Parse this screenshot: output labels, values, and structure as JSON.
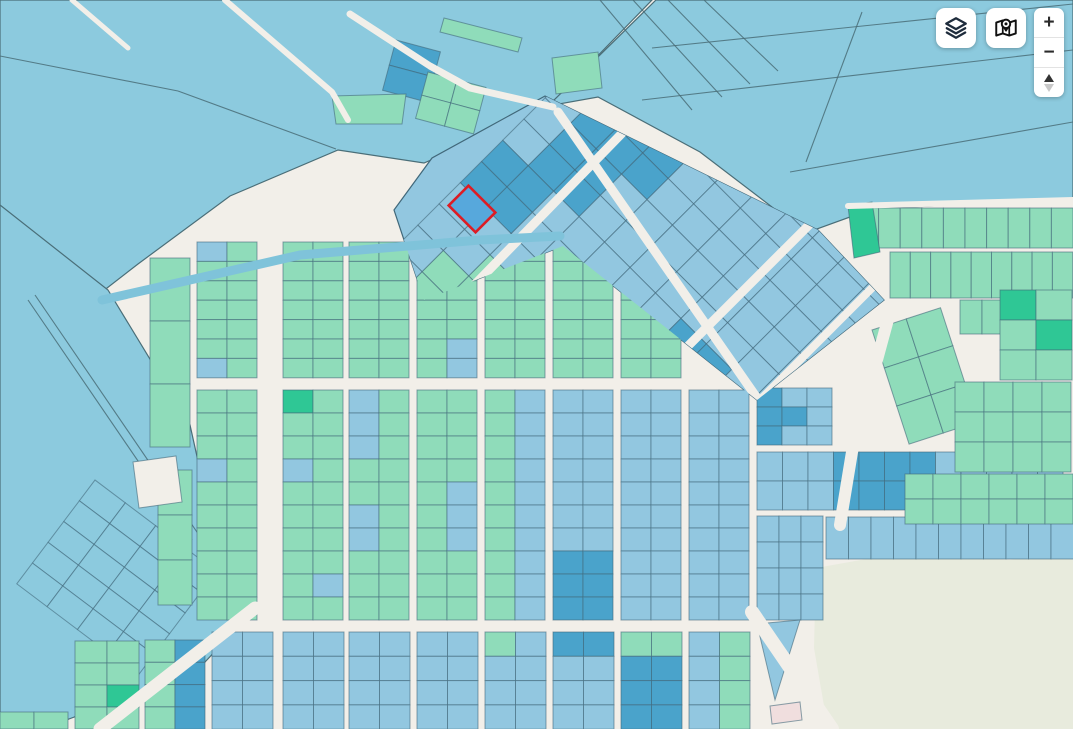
{
  "controls": {
    "zoom_in_label": "+",
    "zoom_out_label": "−",
    "layers_button": {
      "icon": "layers-icon"
    },
    "basemap_button": {
      "icon": "map-pin-icon"
    }
  },
  "palette": {
    "street": "#f2efe9",
    "field": "#8ccade",
    "blue": "#92c7e0",
    "darkBlue": "#4aa3cb",
    "green": "#8fdcba",
    "darkGreen": "#2fc795",
    "beige": "#e8ebdd",
    "border": "#41687a",
    "fieldLine": "#4a6e78",
    "water": "#7fc3da",
    "pink": "#f0dede",
    "red": "#dd1c24",
    "selBlue": "#57a8dc",
    "iconNavy": "#1e2c3c",
    "iconBlack": "#111111"
  },
  "map": {
    "w": 1073,
    "h": 729,
    "clips": {
      "zone": "545,96 818,230 884,300 757,400 563,246 424,300 394,210 432,158",
      "upper": "185,232 562,232 760,404 185,404"
    },
    "regions": [
      {
        "name": "field-top-left",
        "pts": "0,0 652,0 543,112 424,163 338,150 230,196 138,264 40,340 0,362",
        "f": "field",
        "s": "fieldLine"
      },
      {
        "name": "field-top-right",
        "pts": "656,0 1073,0 1073,199 872,209 806,233 700,152 598,97 548,106",
        "f": "field",
        "s": "fieldLine"
      },
      {
        "name": "field-left",
        "pts": "0,205 108,290 190,425 220,560 252,612 205,662 120,700 42,729 0,729",
        "f": "field",
        "s": "fieldLine"
      },
      {
        "name": "diamond-zone",
        "pts": "545,96 818,230 884,300 757,400 563,246 424,300 394,210 432,158",
        "f": "blue",
        "s": "border"
      },
      {
        "name": "park",
        "pts": "816,568 900,553 1010,560 1073,549 1073,729 828,729 814,648",
        "f": "beige",
        "s": "none"
      }
    ],
    "lines": [
      [
        70,
        0,
        128,
        47
      ],
      [
        0,
        56,
        178,
        91
      ],
      [
        178,
        91,
        336,
        149
      ],
      [
        652,
        48,
        1073,
        4
      ],
      [
        642,
        100,
        1073,
        50
      ],
      [
        790,
        172,
        1073,
        122
      ],
      [
        862,
        12,
        806,
        162
      ],
      [
        600,
        0,
        692,
        110
      ],
      [
        633,
        0,
        722,
        97
      ],
      [
        668,
        0,
        750,
        84
      ],
      [
        704,
        0,
        778,
        71
      ],
      [
        28,
        300,
        192,
        540
      ],
      [
        35,
        295,
        199,
        535
      ]
    ],
    "grids": [
      {
        "name": "mesh-bottom-left",
        "x": 95,
        "y": 480,
        "angle": 37,
        "cols": 4,
        "rows": 5,
        "cw": 38,
        "ch": 26,
        "f": "field"
      },
      {
        "name": "strip-left-a",
        "x": 150,
        "y": 258,
        "cols": 1,
        "rows": 3,
        "cw": 40,
        "ch": 63,
        "f": "green"
      },
      {
        "name": "strip-left-b",
        "x": 158,
        "y": 470,
        "cols": 1,
        "rows": 3,
        "cw": 34,
        "ch": 45,
        "f": "green"
      },
      {
        "name": "upper-1",
        "x": 197,
        "y": 242,
        "cols": 2,
        "rows": 7,
        "cw": 30,
        "ch": 19.4,
        "f": "green",
        "clip": "upper",
        "sp": [
          [
            0,
            0,
            "blue"
          ],
          [
            0,
            6,
            "blue"
          ]
        ]
      },
      {
        "name": "upper-2",
        "x": 283,
        "y": 242,
        "cols": 2,
        "rows": 7,
        "cw": 30,
        "ch": 19.4,
        "f": "green",
        "clip": "upper"
      },
      {
        "name": "upper-3",
        "x": 349,
        "y": 242,
        "cols": 2,
        "rows": 7,
        "cw": 30,
        "ch": 19.4,
        "f": "green",
        "clip": "upper"
      },
      {
        "name": "upper-4",
        "x": 417,
        "y": 242,
        "cols": 2,
        "rows": 7,
        "cw": 30,
        "ch": 19.4,
        "f": "green",
        "clip": "upper",
        "sp": [
          [
            1,
            5,
            "blue"
          ],
          [
            1,
            6,
            "blue"
          ]
        ]
      },
      {
        "name": "upper-5",
        "x": 485,
        "y": 242,
        "cols": 2,
        "rows": 7,
        "cw": 30,
        "ch": 19.4,
        "f": "green",
        "clip": "upper"
      },
      {
        "name": "upper-6",
        "x": 553,
        "y": 242,
        "cols": 2,
        "rows": 7,
        "cw": 30,
        "ch": 19.4,
        "f": "green",
        "clip": "upper"
      },
      {
        "name": "upper-7",
        "x": 621,
        "y": 242,
        "cols": 2,
        "rows": 7,
        "cw": 30,
        "ch": 19.4,
        "f": "green",
        "clip": "upper"
      },
      {
        "name": "mid-1",
        "x": 197,
        "y": 390,
        "cols": 2,
        "rows": 10,
        "cw": 30,
        "ch": 23,
        "f": "green",
        "sp": [
          [
            0,
            3,
            "blue"
          ]
        ]
      },
      {
        "name": "mid-2",
        "x": 283,
        "y": 390,
        "cols": 2,
        "rows": 10,
        "cw": 30,
        "ch": 23,
        "f": "green",
        "sp": [
          [
            0,
            0,
            "darkGreen"
          ],
          [
            0,
            3,
            "blue"
          ],
          [
            1,
            8,
            "blue"
          ]
        ]
      },
      {
        "name": "mid-3",
        "x": 349,
        "y": 390,
        "cols": 2,
        "rows": 10,
        "cw": 30,
        "ch": 23,
        "f": "green",
        "sp": [
          [
            0,
            0,
            "blue"
          ],
          [
            0,
            1,
            "blue"
          ],
          [
            0,
            2,
            "blue"
          ],
          [
            0,
            5,
            "blue"
          ],
          [
            0,
            6,
            "blue"
          ]
        ]
      },
      {
        "name": "mid-4",
        "x": 417,
        "y": 390,
        "cols": 2,
        "rows": 10,
        "cw": 30,
        "ch": 23,
        "f": "green",
        "sp": [
          [
            1,
            4,
            "blue"
          ],
          [
            1,
            5,
            "blue"
          ],
          [
            1,
            6,
            "blue"
          ]
        ]
      },
      {
        "name": "mid-5",
        "x": 485,
        "y": 390,
        "cols": 2,
        "rows": 10,
        "cw": 30,
        "ch": 23,
        "colFills": [
          "green",
          "blue"
        ]
      },
      {
        "name": "mid-6",
        "x": 553,
        "y": 390,
        "cols": 2,
        "rows": 10,
        "cw": 30,
        "ch": 23,
        "f": "blue",
        "sp": [
          [
            0,
            7,
            "darkBlue"
          ],
          [
            0,
            8,
            "darkBlue"
          ],
          [
            0,
            9,
            "darkBlue"
          ],
          [
            1,
            7,
            "darkBlue"
          ],
          [
            1,
            8,
            "darkBlue"
          ],
          [
            1,
            9,
            "darkBlue"
          ]
        ]
      },
      {
        "name": "mid-7",
        "x": 621,
        "y": 390,
        "cols": 2,
        "rows": 10,
        "cw": 30,
        "ch": 23,
        "f": "blue"
      },
      {
        "name": "mid-8",
        "x": 689,
        "y": 390,
        "cols": 2,
        "rows": 10,
        "cw": 30,
        "ch": 23,
        "f": "blue"
      },
      {
        "name": "bot-0",
        "x": 75,
        "y": 641,
        "cols": 2,
        "rows": 4,
        "cw": 32,
        "ch": 22,
        "f": "green",
        "sp": [
          [
            1,
            2,
            "darkGreen"
          ]
        ]
      },
      {
        "name": "bot-1",
        "x": 145,
        "y": 640,
        "cols": 2,
        "rows": 4,
        "cw": 30,
        "ch": 22.3,
        "colFills": [
          "green",
          "darkBlue"
        ]
      },
      {
        "name": "bot-2",
        "x": 212,
        "y": 632,
        "cols": 2,
        "rows": 4,
        "cw": 30.5,
        "ch": 24.3,
        "f": "blue"
      },
      {
        "name": "bot-3",
        "x": 283,
        "y": 632,
        "cols": 2,
        "rows": 4,
        "cw": 30.5,
        "ch": 24.3,
        "f": "blue"
      },
      {
        "name": "bot-4",
        "x": 349,
        "y": 632,
        "cols": 2,
        "rows": 4,
        "cw": 30.5,
        "ch": 24.3,
        "f": "blue"
      },
      {
        "name": "bot-5",
        "x": 417,
        "y": 632,
        "cols": 2,
        "rows": 4,
        "cw": 30.5,
        "ch": 24.3,
        "f": "blue"
      },
      {
        "name": "bot-6",
        "x": 485,
        "y": 632,
        "cols": 2,
        "rows": 4,
        "cw": 30.5,
        "ch": 24.3,
        "f": "blue",
        "sp": [
          [
            0,
            0,
            "green"
          ]
        ]
      },
      {
        "name": "bot-7",
        "x": 553,
        "y": 632,
        "cols": 2,
        "rows": 4,
        "cw": 30.5,
        "ch": 24.3,
        "f": "blue",
        "sp": [
          [
            0,
            0,
            "darkBlue"
          ],
          [
            1,
            0,
            "darkBlue"
          ]
        ]
      },
      {
        "name": "bot-8",
        "x": 621,
        "y": 632,
        "cols": 2,
        "rows": 4,
        "cw": 30.5,
        "ch": 24.3,
        "f": "blue",
        "sp": [
          [
            0,
            0,
            "green"
          ],
          [
            1,
            0,
            "green"
          ],
          [
            0,
            1,
            "darkBlue"
          ],
          [
            1,
            1,
            "darkBlue"
          ],
          [
            0,
            2,
            "darkBlue"
          ],
          [
            1,
            2,
            "darkBlue"
          ],
          [
            0,
            3,
            "darkBlue"
          ],
          [
            1,
            3,
            "darkBlue"
          ]
        ]
      },
      {
        "name": "bot-9",
        "x": 689,
        "y": 632,
        "cols": 2,
        "rows": 4,
        "cw": 30.5,
        "ch": 24.3,
        "colFills": [
          "blue",
          "green"
        ]
      },
      {
        "name": "bot-tiny",
        "x": 0,
        "y": 712,
        "cols": 2,
        "rows": 1,
        "cw": 34,
        "ch": 17,
        "f": "green"
      },
      {
        "name": "rmid-1",
        "x": 757,
        "y": 388,
        "cols": 3,
        "rows": 3,
        "cw": 25,
        "ch": 19,
        "f": "blue",
        "sp": [
          [
            0,
            0,
            "darkBlue"
          ],
          [
            0,
            1,
            "darkBlue"
          ],
          [
            0,
            2,
            "darkBlue"
          ],
          [
            1,
            1,
            "darkBlue"
          ]
        ]
      },
      {
        "name": "rmid-2",
        "x": 757,
        "y": 452,
        "cols": 12,
        "rows": 2,
        "cw": 25.5,
        "ch": 29,
        "f": "blue",
        "sp": [
          [
            3,
            0,
            "darkBlue"
          ],
          [
            4,
            0,
            "darkBlue"
          ],
          [
            5,
            0,
            "darkBlue"
          ],
          [
            6,
            0,
            "darkBlue"
          ],
          [
            3,
            1,
            "darkBlue"
          ],
          [
            4,
            1,
            "darkBlue"
          ],
          [
            5,
            1,
            "darkBlue"
          ],
          [
            6,
            1,
            "darkBlue"
          ]
        ]
      },
      {
        "name": "rmid-3",
        "x": 757,
        "y": 516,
        "cols": 3,
        "rows": 4,
        "cw": 22,
        "ch": 26,
        "f": "blue"
      },
      {
        "name": "rmid-strip",
        "x": 826,
        "y": 517,
        "cols": 11,
        "rows": 1,
        "cw": 22.5,
        "ch": 42,
        "f": "blue"
      },
      {
        "name": "rgreen-1",
        "x": 857,
        "y": 208,
        "cols": 10,
        "rows": 1,
        "cw": 21.6,
        "ch": 40,
        "f": "green"
      },
      {
        "name": "rgreen-2",
        "x": 890,
        "y": 252,
        "cols": 9,
        "rows": 1,
        "cw": 20.3,
        "ch": 46,
        "f": "green"
      },
      {
        "name": "rgreen-3",
        "x": 960,
        "y": 300,
        "cols": 2,
        "rows": 1,
        "cw": 22,
        "ch": 34,
        "f": "green"
      },
      {
        "name": "rgreen-4",
        "x": 1000,
        "y": 290,
        "cols": 2,
        "rows": 3,
        "cw": 36,
        "ch": 30,
        "f": "green",
        "sp": [
          [
            0,
            0,
            "darkGreen"
          ],
          [
            1,
            1,
            "darkGreen"
          ]
        ]
      },
      {
        "name": "rgreen-5",
        "x": 872,
        "y": 330,
        "angle": -18,
        "cols": 2,
        "rows": 3,
        "cw": 36,
        "ch": 40,
        "f": "green"
      },
      {
        "name": "rgreen-6",
        "x": 955,
        "y": 382,
        "cols": 4,
        "rows": 3,
        "cw": 29,
        "ch": 30,
        "f": "green"
      },
      {
        "name": "rgreen-7",
        "x": 905,
        "y": 474,
        "cols": 6,
        "rows": 2,
        "cw": 28,
        "ch": 25,
        "f": "green"
      },
      {
        "name": "top-dark-pair",
        "x": 396,
        "y": 40,
        "angle": 15,
        "cols": 1,
        "rows": 2,
        "cw": 46,
        "ch": 26,
        "f": "darkBlue"
      },
      {
        "name": "top-greens",
        "x": 428,
        "y": 72,
        "angle": 15,
        "cols": 2,
        "rows": 2,
        "cw": 30,
        "ch": 24,
        "f": "green"
      },
      {
        "name": "diamond",
        "x": 630,
        "y": 13,
        "angle": 45,
        "cols": 11,
        "rows": 12,
        "cw": 36,
        "ch": 30,
        "f": "blue",
        "clip": "zone",
        "sp": [
          [
            1,
            3,
            "darkBlue"
          ],
          [
            1,
            4,
            "darkBlue"
          ],
          [
            1,
            5,
            "darkBlue"
          ],
          [
            1,
            6,
            "darkBlue"
          ],
          [
            1,
            7,
            "darkBlue"
          ],
          [
            2,
            2,
            "darkBlue"
          ],
          [
            2,
            3,
            "darkBlue"
          ],
          [
            2,
            4,
            "darkBlue"
          ],
          [
            2,
            5,
            "darkBlue"
          ],
          [
            3,
            2,
            "darkBlue"
          ],
          [
            3,
            3,
            "darkBlue"
          ],
          [
            0,
            6,
            "darkBlue"
          ],
          [
            0,
            7,
            "darkBlue"
          ],
          [
            7,
            6,
            "darkBlue"
          ],
          [
            8,
            6,
            "darkBlue"
          ],
          [
            1,
            10,
            "green"
          ],
          [
            1,
            11,
            "green"
          ],
          [
            2,
            9,
            "green"
          ],
          [
            2,
            10,
            "green"
          ],
          [
            3,
            9,
            "green"
          ]
        ]
      }
    ],
    "polys": [
      {
        "name": "dark-green-parcel",
        "pts": "848,206 872,202 880,252 854,258",
        "f": "darkGreen"
      },
      {
        "name": "green-band-a",
        "pts": "444,18 522,38 518,52 440,32",
        "f": "green"
      },
      {
        "name": "green-band-b",
        "pts": "332,96 406,94 402,124 336,124",
        "f": "green"
      },
      {
        "name": "green-band-c",
        "pts": "552,58 598,52 602,88 556,94",
        "f": "green"
      },
      {
        "name": "blue-triangle",
        "pts": "757,624 800,620 775,700",
        "f": "blue"
      },
      {
        "name": "pink-building",
        "pts": "770,706 800,702 802,720 772,724",
        "f": "pink"
      },
      {
        "name": "courtyard",
        "pts": "133,462 176,456 182,502 139,508",
        "f": "street"
      }
    ],
    "roads": [
      {
        "p": "72,0 128,48",
        "w": 5,
        "c": "street"
      },
      {
        "p": "225,0 332,92 348,120",
        "w": 6,
        "c": "street"
      },
      {
        "p": "350,14 430,66 470,88 553,107",
        "w": 7,
        "c": "street"
      },
      {
        "p": "452,308 666,88",
        "w": 9,
        "c": "street",
        "clip": "zone"
      },
      {
        "p": "640,394 828,206",
        "w": 9,
        "c": "street",
        "clip": "zone"
      },
      {
        "p": "762,398 884,276",
        "w": 8,
        "c": "street",
        "clip": "zone"
      },
      {
        "p": "558,112 757,398",
        "w": 9,
        "c": "street",
        "clip": "zone"
      },
      {
        "p": "890,312 852,452 840,525",
        "w": 12,
        "c": "street"
      },
      {
        "p": "752,612 832,729",
        "w": 14,
        "c": "street"
      },
      {
        "p": "255,608 100,729",
        "w": 13,
        "c": "street"
      },
      {
        "p": "848,206 1073,200",
        "w": 6,
        "c": "street"
      },
      {
        "p": "102,300 300,255 480,240 560,236",
        "w": 9,
        "c": "water"
      }
    ],
    "selected_parcel": {
      "cx": 472,
      "cy": 209,
      "w": 38,
      "h": 28,
      "angle": 45,
      "f": "selBlue",
      "s": "red"
    }
  }
}
